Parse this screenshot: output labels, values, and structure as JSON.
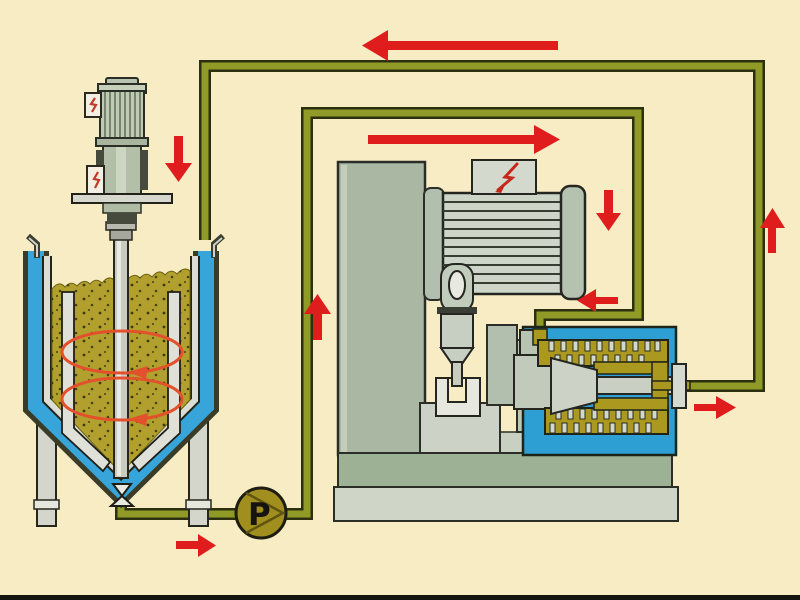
{
  "scene": {
    "type": "process-flow-diagram",
    "description": "Closed-loop wet-milling circulation: jacketed stirred feed vessel with top agitator, circulation pump P, horizontal agitator bead mill with cooled grinding chamber, olive piping loop with red flow arrows",
    "background_color": "#f7ecc4",
    "pump": {
      "label": "P",
      "fill": "#a08e1f"
    },
    "colors": {
      "pipe_fill": "#8f9a27",
      "pipe_outline": "#2c3010",
      "flow_arrow_red": "#df1d1d",
      "vessel_jacket_blue": "#37a5da",
      "product_olive": "#b2a02e",
      "product_speckle": "#3f3a0c",
      "circulation_arrow_orange": "#e2512b",
      "machine_sage": "#a9b7a3",
      "motor_light_gray": "#cdd5c9",
      "mill_chamber_blue": "#2e9fd2",
      "mill_channel_olive": "#ab991f",
      "lightning_red": "#c5281c"
    },
    "components": [
      {
        "name": "stirred-feed-vessel",
        "parts": [
          "blue-cooling-jacket",
          "gray-inner-lining",
          "olive-speckled-product",
          "two-internal-baffles",
          "central-agitator-shaft",
          "two-orange-circulation-ellipse-arrows",
          "rim-hooks",
          "two-support-legs",
          "bottom-outlet-valve"
        ]
      },
      {
        "name": "agitator-drive",
        "parts": [
          "vertically-striped-motor",
          "two-terminal-boxes-with-red-marks",
          "mounting-plate",
          "shaft-collars"
        ]
      },
      {
        "name": "circulation-pump",
        "parts": [
          "olive-circle",
          "black-letter-P",
          "triangle-chords"
        ]
      },
      {
        "name": "bead-mill",
        "parts": [
          "stand-column",
          "horizontally-striped-drive-motor",
          "terminal-box-with-red-lightning",
          "coupling-and-funnel-stack",
          "u-bracket",
          "pedestal-blocks",
          "two-tier-machine-base",
          "blue-grinding-chamber",
          "olive-pin-toothed-product-channels",
          "gray-rotor",
          "outlet-flange"
        ]
      },
      {
        "name": "piping",
        "parts": [
          "feed-line-vessel-to-pump-to-mill",
          "return-line-mill-to-vessel"
        ]
      }
    ],
    "flow_arrows": [
      {
        "id": "return-line-top",
        "direction": "left"
      },
      {
        "id": "feed-line-top",
        "direction": "right"
      },
      {
        "id": "vessel-inlet",
        "direction": "down"
      },
      {
        "id": "feed-riser",
        "direction": "up"
      },
      {
        "id": "mill-motor-side",
        "direction": "down"
      },
      {
        "id": "mill-inlet",
        "direction": "left"
      },
      {
        "id": "return-riser",
        "direction": "up"
      },
      {
        "id": "mill-outlet",
        "direction": "right"
      },
      {
        "id": "pump-suction",
        "direction": "right"
      }
    ]
  }
}
